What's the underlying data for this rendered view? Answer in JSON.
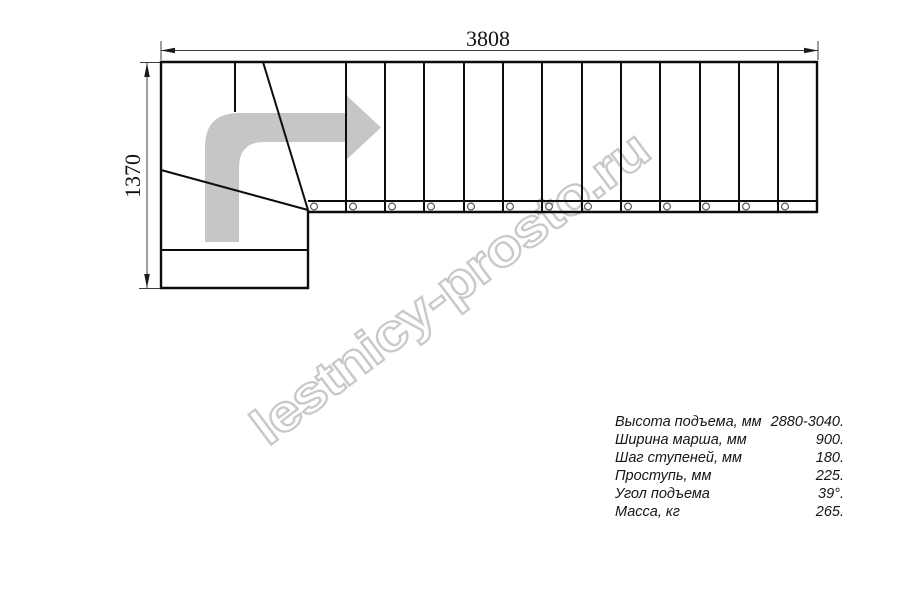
{
  "watermark": {
    "text": "lestnicy-prosto.ru",
    "color": "#c9c9c9"
  },
  "drawing": {
    "arrow_color": "#c6c6c6",
    "dimensions": {
      "width_label": "3808",
      "height_label": "1370"
    }
  },
  "specs": {
    "rows": [
      {
        "label": "Высота подъема, мм",
        "value": "2880-3040."
      },
      {
        "label": "Ширина марша, мм",
        "value": "900."
      },
      {
        "label": "Шаг ступеней, мм",
        "value": "180."
      },
      {
        "label": "Проступь, мм",
        "value": "225."
      },
      {
        "label": "Угол подъема",
        "value": "39°."
      },
      {
        "label": "Масса, кг",
        "value": "265."
      }
    ]
  }
}
